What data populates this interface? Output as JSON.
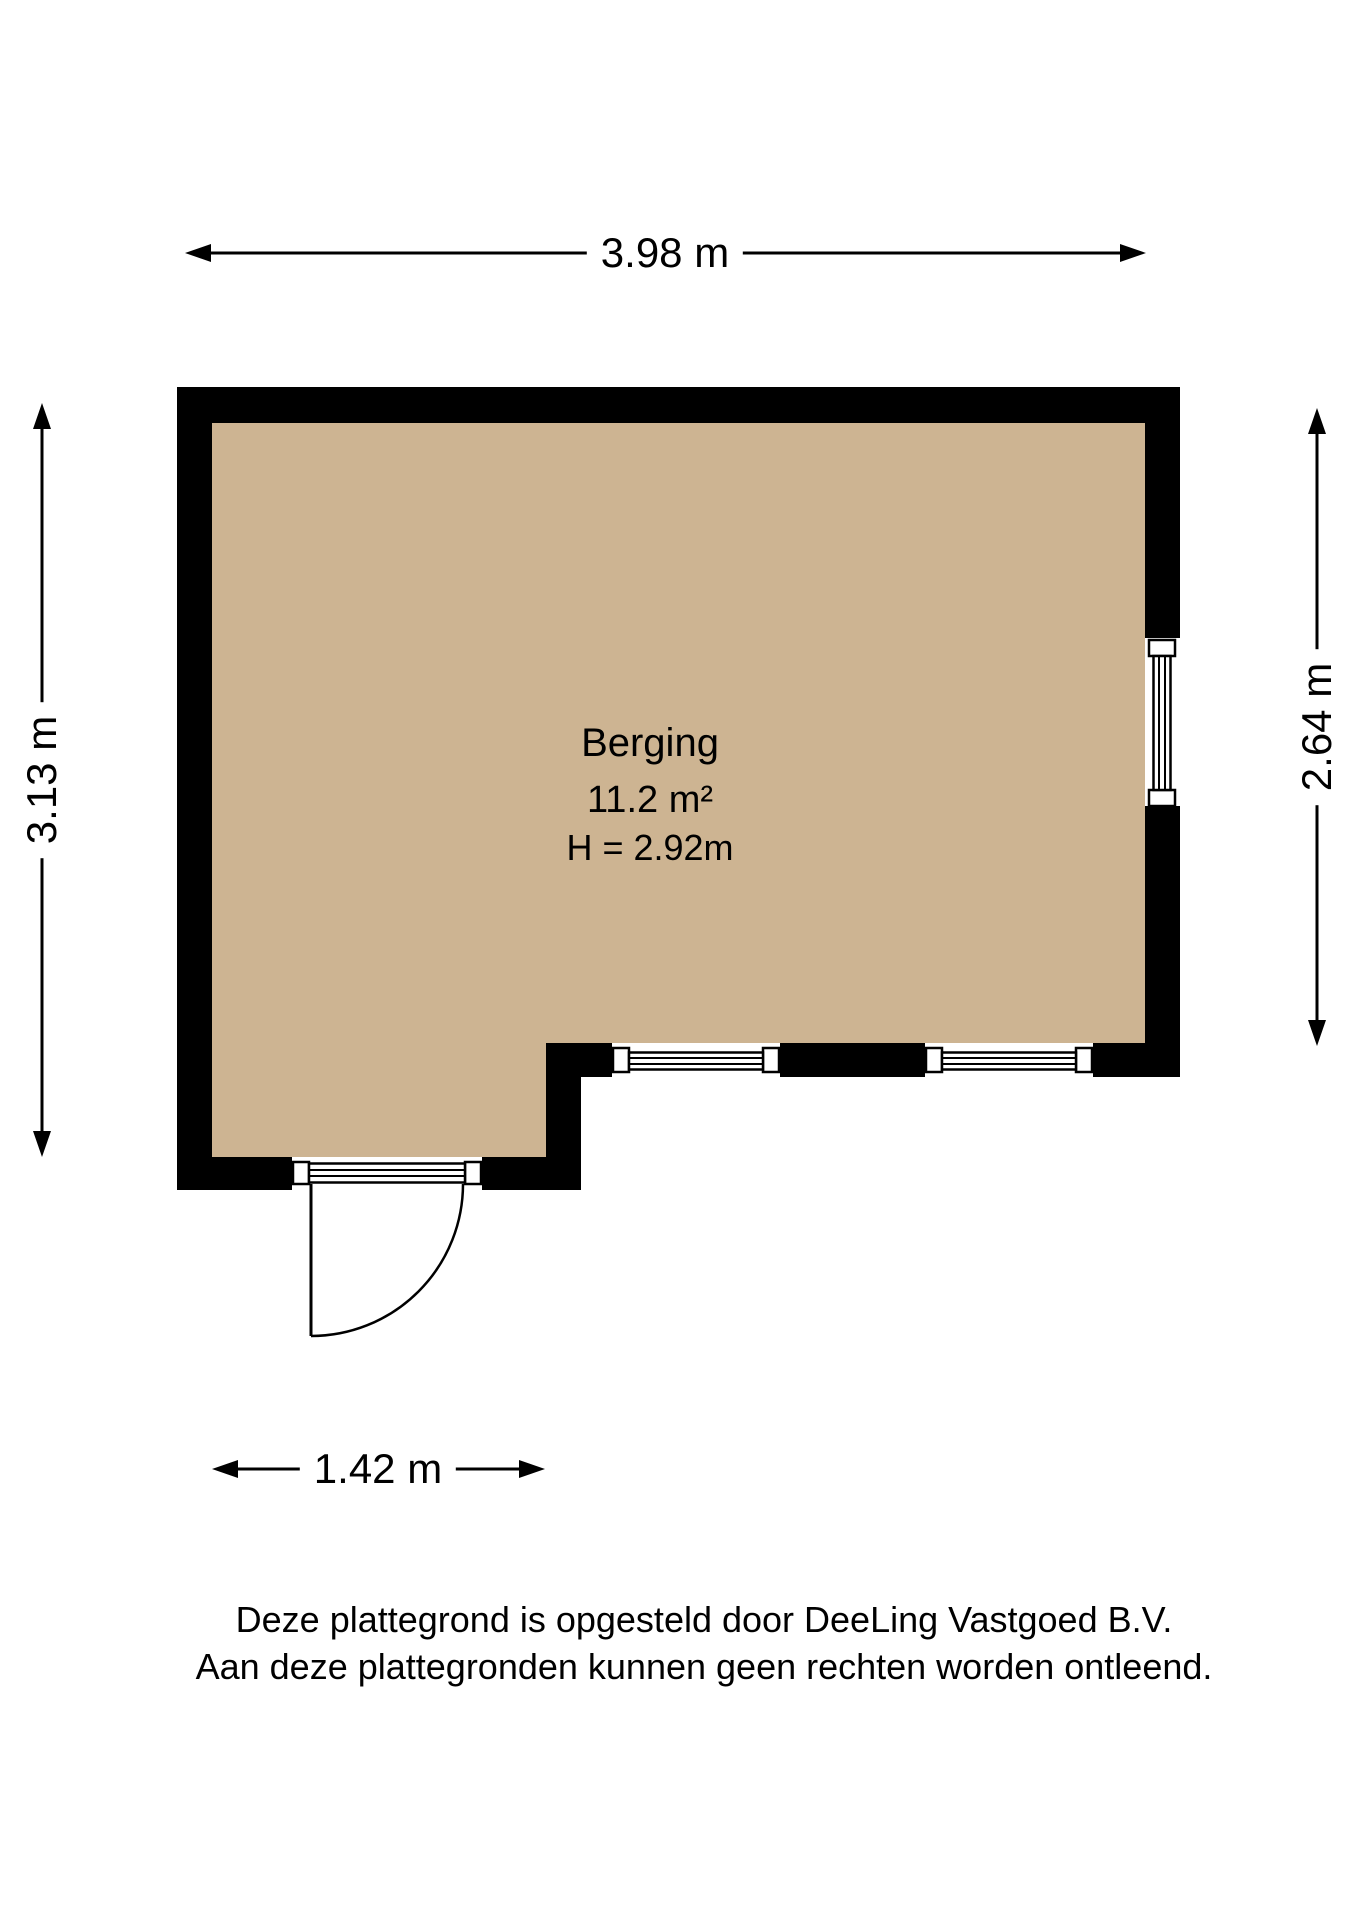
{
  "plan": {
    "room": {
      "name": "Berging",
      "area": "11.2 m²",
      "ceiling_height": "H = 2.92m"
    },
    "dimensions": {
      "top": "3.98 m",
      "left": "3.13 m",
      "right": "2.64 m",
      "bottom": "1.42 m"
    },
    "colors": {
      "floor": "#cdb492",
      "wall": "#000000",
      "background": "#ffffff"
    }
  },
  "footer": {
    "line1": "Deze plattegrond is opgesteld door DeeLing Vastgoed B.V.",
    "line2": "Aan deze plattegronden kunnen geen rechten worden ontleend."
  }
}
